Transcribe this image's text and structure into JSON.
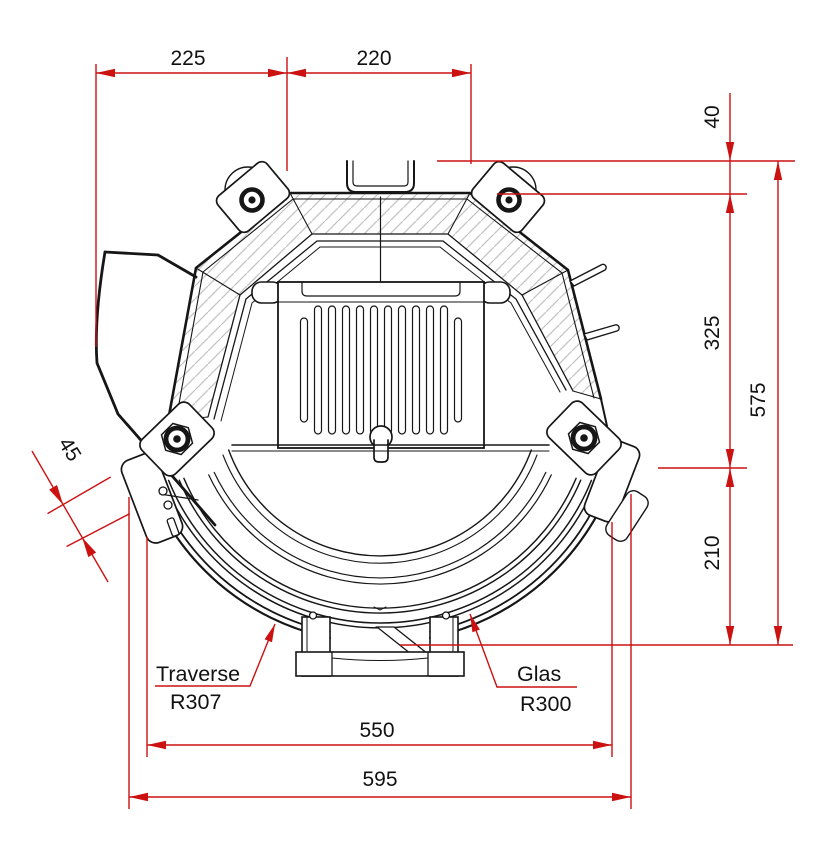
{
  "drawing": {
    "kind": "stove firebox cross-section, top view",
    "background": "#ffffff"
  },
  "dims": {
    "d225": "225",
    "d220": "220",
    "d40": "40",
    "d325": "325",
    "d575": "575",
    "d210": "210",
    "d45": "45",
    "d550": "550",
    "d595": "595"
  },
  "labels": {
    "traverse_name": "Traverse",
    "traverse_radius": "R307",
    "glas_name": "Glas",
    "glas_radius": "R300"
  },
  "colors": {
    "dimension_red": "#cc1111",
    "line_black": "#161616",
    "hatch_gray": "#c4c4c4"
  }
}
